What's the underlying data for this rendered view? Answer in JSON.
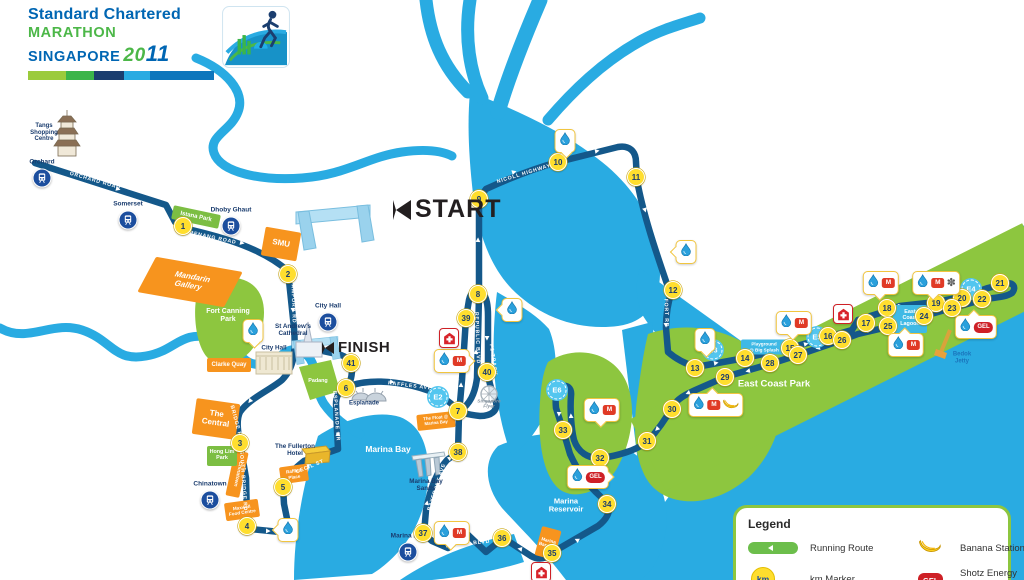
{
  "colors": {
    "water": "#29ABE2",
    "route": "#14588A",
    "park": "#8DC63F",
    "km-yellow": "#FFDE2E",
    "orange": "#F7941E",
    "mrt-blue": "#1C4E9E",
    "red": "#CE2026",
    "legend-green": "#8DC63F",
    "navy": "#1A3C6E",
    "e-blue": "#53C6EF"
  },
  "logo": {
    "brand": "Standard Chartered",
    "event": "MARATHON",
    "city": "SINGAPORE",
    "year_a": "20",
    "year_b": "11"
  },
  "icons": {
    "m": "M",
    "gel": "GEL",
    "km": "km",
    "fan": "✽"
  },
  "map": {
    "start_label": "START",
    "finish_label": "FINISH",
    "km_markers": [
      {
        "n": 1,
        "x": 183,
        "y": 226
      },
      {
        "n": 2,
        "x": 288,
        "y": 274
      },
      {
        "n": 3,
        "x": 240,
        "y": 443
      },
      {
        "n": 4,
        "x": 247,
        "y": 526
      },
      {
        "n": 5,
        "x": 283,
        "y": 487
      },
      {
        "n": 6,
        "x": 346,
        "y": 388
      },
      {
        "n": 7,
        "x": 458,
        "y": 411
      },
      {
        "n": 8,
        "x": 478,
        "y": 294
      },
      {
        "n": 9,
        "x": 479,
        "y": 199
      },
      {
        "n": 10,
        "x": 558,
        "y": 162
      },
      {
        "n": 11,
        "x": 636,
        "y": 177
      },
      {
        "n": 12,
        "x": 673,
        "y": 290
      },
      {
        "n": 13,
        "x": 695,
        "y": 368
      },
      {
        "n": 14,
        "x": 745,
        "y": 358
      },
      {
        "n": 15,
        "x": 790,
        "y": 348
      },
      {
        "n": 16,
        "x": 828,
        "y": 336
      },
      {
        "n": 17,
        "x": 866,
        "y": 323
      },
      {
        "n": 18,
        "x": 887,
        "y": 308
      },
      {
        "n": 19,
        "x": 936,
        "y": 303
      },
      {
        "n": 20,
        "x": 962,
        "y": 298
      },
      {
        "n": 21,
        "x": 1000,
        "y": 283
      },
      {
        "n": 22,
        "x": 982,
        "y": 299
      },
      {
        "n": 23,
        "x": 952,
        "y": 308
      },
      {
        "n": 24,
        "x": 924,
        "y": 316
      },
      {
        "n": 25,
        "x": 888,
        "y": 326
      },
      {
        "n": 26,
        "x": 842,
        "y": 340
      },
      {
        "n": 27,
        "x": 798,
        "y": 355
      },
      {
        "n": 28,
        "x": 770,
        "y": 363
      },
      {
        "n": 29,
        "x": 725,
        "y": 377
      },
      {
        "n": 30,
        "x": 672,
        "y": 409
      },
      {
        "n": 31,
        "x": 647,
        "y": 441
      },
      {
        "n": 32,
        "x": 600,
        "y": 458
      },
      {
        "n": 33,
        "x": 563,
        "y": 430
      },
      {
        "n": 34,
        "x": 607,
        "y": 504
      },
      {
        "n": 35,
        "x": 552,
        "y": 553
      },
      {
        "n": 36,
        "x": 502,
        "y": 538
      },
      {
        "n": 37,
        "x": 423,
        "y": 533
      },
      {
        "n": 38,
        "x": 458,
        "y": 452
      },
      {
        "n": 39,
        "x": 466,
        "y": 318
      },
      {
        "n": 40,
        "x": 487,
        "y": 372
      },
      {
        "n": 41,
        "x": 351,
        "y": 363
      }
    ],
    "stations": [
      {
        "name": "Orchard",
        "x": 42,
        "y": 178
      },
      {
        "name": "Somerset",
        "x": 128,
        "y": 220
      },
      {
        "name": "Dhoby Ghaut",
        "x": 231,
        "y": 226
      },
      {
        "name": "City Hall",
        "x": 328,
        "y": 322
      },
      {
        "name": "Chinatown",
        "x": 210,
        "y": 500
      },
      {
        "name": "Marina Bay",
        "x": 408,
        "y": 552
      }
    ],
    "e_markers": [
      {
        "label": "E2",
        "x": 438,
        "y": 397
      },
      {
        "label": "E3",
        "x": 713,
        "y": 350
      },
      {
        "label": "E4",
        "x": 971,
        "y": 289
      },
      {
        "label": "E5",
        "x": 817,
        "y": 337
      },
      {
        "label": "E6",
        "x": 557,
        "y": 390
      }
    ],
    "aid_stations": [
      {
        "x": 253,
        "y": 331,
        "icons": [
          "water"
        ],
        "ptr": "down"
      },
      {
        "x": 565,
        "y": 141,
        "icons": [
          "water"
        ],
        "ptr": "down"
      },
      {
        "x": 686,
        "y": 252,
        "icons": [
          "water"
        ],
        "ptr": "left"
      },
      {
        "x": 512,
        "y": 310,
        "icons": [
          "water"
        ],
        "ptr": "left"
      },
      {
        "x": 288,
        "y": 530,
        "icons": [
          "water"
        ],
        "ptr": "left"
      },
      {
        "x": 705,
        "y": 340,
        "icons": [
          "water"
        ],
        "ptr": "down"
      },
      {
        "x": 452,
        "y": 361,
        "icons": [
          "water",
          "m"
        ],
        "ptr": "right"
      },
      {
        "x": 602,
        "y": 410,
        "icons": [
          "water",
          "m"
        ],
        "ptr": "down"
      },
      {
        "x": 452,
        "y": 533,
        "icons": [
          "water",
          "m"
        ],
        "ptr": "down"
      },
      {
        "x": 881,
        "y": 283,
        "icons": [
          "water",
          "m"
        ],
        "ptr": "down"
      },
      {
        "x": 794,
        "y": 323,
        "icons": [
          "water",
          "m"
        ],
        "ptr": "down"
      },
      {
        "x": 906,
        "y": 345,
        "icons": [
          "water",
          "m"
        ],
        "ptr": "up"
      },
      {
        "x": 716,
        "y": 405,
        "icons": [
          "water",
          "m",
          "banana"
        ],
        "ptr": "up"
      },
      {
        "x": 936,
        "y": 283,
        "icons": [
          "water",
          "m",
          "fan"
        ],
        "ptr": "down"
      },
      {
        "x": 588,
        "y": 477,
        "icons": [
          "water",
          "gel"
        ],
        "ptr": "right"
      },
      {
        "x": 976,
        "y": 327,
        "icons": [
          "water",
          "gel"
        ],
        "ptr": "up"
      }
    ],
    "first_aid": [
      {
        "x": 449,
        "y": 338
      },
      {
        "x": 843,
        "y": 314
      },
      {
        "x": 541,
        "y": 572
      }
    ],
    "poi_orange": [
      {
        "text": "Mandarin\nGallery",
        "x": 190,
        "y": 282,
        "w": 86,
        "h": 36,
        "rot": 10,
        "skew": -18,
        "fs": 8
      },
      {
        "text": "SMU",
        "x": 281,
        "y": 244,
        "w": 34,
        "h": 27,
        "rot": 10,
        "fs": 8
      },
      {
        "text": "The\nCentral",
        "x": 216,
        "y": 419,
        "w": 42,
        "h": 34,
        "rot": 8,
        "fs": 8
      },
      {
        "text": "Clarke Quay",
        "x": 229,
        "y": 365,
        "w": 42,
        "h": 12,
        "rot": 0,
        "fs": 6
      },
      {
        "text": "Maxwell\nFood Centre",
        "x": 242,
        "y": 510,
        "w": 32,
        "h": 16,
        "rot": -8,
        "fs": 4.6
      },
      {
        "text": "Raffles\nPlace",
        "x": 294,
        "y": 474,
        "w": 26,
        "h": 15,
        "rot": -8,
        "fs": 4.6
      },
      {
        "text": "Marina\nBarrage",
        "x": 548,
        "y": 543,
        "w": 18,
        "h": 28,
        "rot": 15,
        "fs": 4.6
      },
      {
        "text": "The Float @\nMarina Bay",
        "x": 436,
        "y": 421,
        "w": 36,
        "h": 14,
        "rot": -6,
        "fs": 4.4
      },
      {
        "text": "Chinatown",
        "x": 237,
        "y": 474,
        "w": 12,
        "h": 44,
        "rot": 12,
        "fs": 5,
        "vert": true
      }
    ],
    "poi_green": [
      {
        "text": "Istana Park",
        "x": 196,
        "y": 217,
        "w": 46,
        "h": 12,
        "rot": 12,
        "fs": 6
      },
      {
        "text": "Hong Lim\nPark",
        "x": 222,
        "y": 456,
        "w": 28,
        "h": 18,
        "rot": 0,
        "fs": 5.4
      }
    ],
    "poi_blue": [
      {
        "text": "East\nCoast\nLagoon",
        "x": 910,
        "y": 319,
        "w": 32,
        "h": 26,
        "rot": 0,
        "fs": 5.4
      },
      {
        "text": "Playground\n@ Big Splash",
        "x": 764,
        "y": 347,
        "w": 44,
        "h": 13,
        "rot": 0,
        "fs": 4.6
      }
    ],
    "road_labels": [
      {
        "text": "ORCHARD ROAD",
        "x": 95,
        "y": 181,
        "rot": 16
      },
      {
        "text": "PENANG ROAD",
        "x": 213,
        "y": 238,
        "rot": 12
      },
      {
        "text": "STAMFORD RD",
        "x": 293,
        "y": 300,
        "rot": 88
      },
      {
        "text": "NEW BRIDGE RD",
        "x": 234,
        "y": 415,
        "rot": 75
      },
      {
        "text": "SOUTH BRIDGE RD",
        "x": 243,
        "y": 481,
        "rot": 86
      },
      {
        "text": "CECIL ST",
        "x": 310,
        "y": 467,
        "rot": -22
      },
      {
        "text": "ESPLANADE DR",
        "x": 336,
        "y": 416,
        "rot": 86
      },
      {
        "text": "RAFFLES AVE",
        "x": 410,
        "y": 386,
        "rot": 7
      },
      {
        "text": "REPUBLIC BLVD",
        "x": 477,
        "y": 338,
        "rot": 88
      },
      {
        "text": "F1 TRACK",
        "x": 493,
        "y": 360,
        "rot": 82
      },
      {
        "text": "NICOLL HIGHWAY",
        "x": 524,
        "y": 174,
        "rot": -17
      },
      {
        "text": "MOUNTBATTEN RD",
        "x": 651,
        "y": 213,
        "rot": 74
      },
      {
        "text": "FORT RD",
        "x": 666,
        "y": 313,
        "rot": 88
      },
      {
        "text": "BAYFRONT AVE",
        "x": 437,
        "y": 487,
        "rot": -72
      },
      {
        "text": "MARINA BLVD",
        "x": 468,
        "y": 544,
        "rot": -6
      }
    ],
    "place_labels": [
      {
        "text": "Tangs\nShopping\nCentre",
        "x": 44,
        "y": 133,
        "cls": "navy",
        "fs": 6
      },
      {
        "text": "St Andrew's\nCathedral",
        "x": 293,
        "y": 330,
        "cls": "navy",
        "fs": 6.3
      },
      {
        "text": "City Hall",
        "x": 274,
        "y": 348,
        "cls": "navy",
        "fs": 6.3
      },
      {
        "text": "Esplanade",
        "x": 364,
        "y": 404,
        "cls": "navy",
        "fs": 6
      },
      {
        "text": "The Fullerton\nHotel",
        "x": 295,
        "y": 450,
        "cls": "navy",
        "fs": 6.3
      },
      {
        "text": "Marina Bay\nSands",
        "x": 426,
        "y": 485,
        "cls": "navy",
        "fs": 6.3
      },
      {
        "text": "Singapore\nFlyer",
        "x": 489,
        "y": 405,
        "cls": "gray",
        "fs": 4.8
      },
      {
        "text": "Bedok\nJetty",
        "x": 962,
        "y": 358,
        "cls": "blue",
        "fs": 6
      },
      {
        "text": "Fort Canning\nPark",
        "x": 228,
        "y": 316,
        "cls": "white",
        "fs": 7
      },
      {
        "text": "Padang",
        "x": 318,
        "y": 381,
        "cls": "white",
        "fs": 5.4
      },
      {
        "text": "East Coast Park",
        "x": 774,
        "y": 385,
        "cls": "white",
        "fs": 9.5
      },
      {
        "text": "Marina Bay",
        "x": 388,
        "y": 450,
        "cls": "white",
        "fs": 8.5
      },
      {
        "text": "Marina\nReservoir",
        "x": 566,
        "y": 506,
        "cls": "white",
        "fs": 7.5
      }
    ]
  },
  "legend": {
    "title": "Legend",
    "items": [
      {
        "icon": "route",
        "label": "Running Route"
      },
      {
        "icon": "km",
        "label": "km Marker"
      },
      {
        "icon": "banana",
        "label": "Banana Station"
      },
      {
        "icon": "gel",
        "label": "Shotz Energy Gel"
      }
    ]
  }
}
